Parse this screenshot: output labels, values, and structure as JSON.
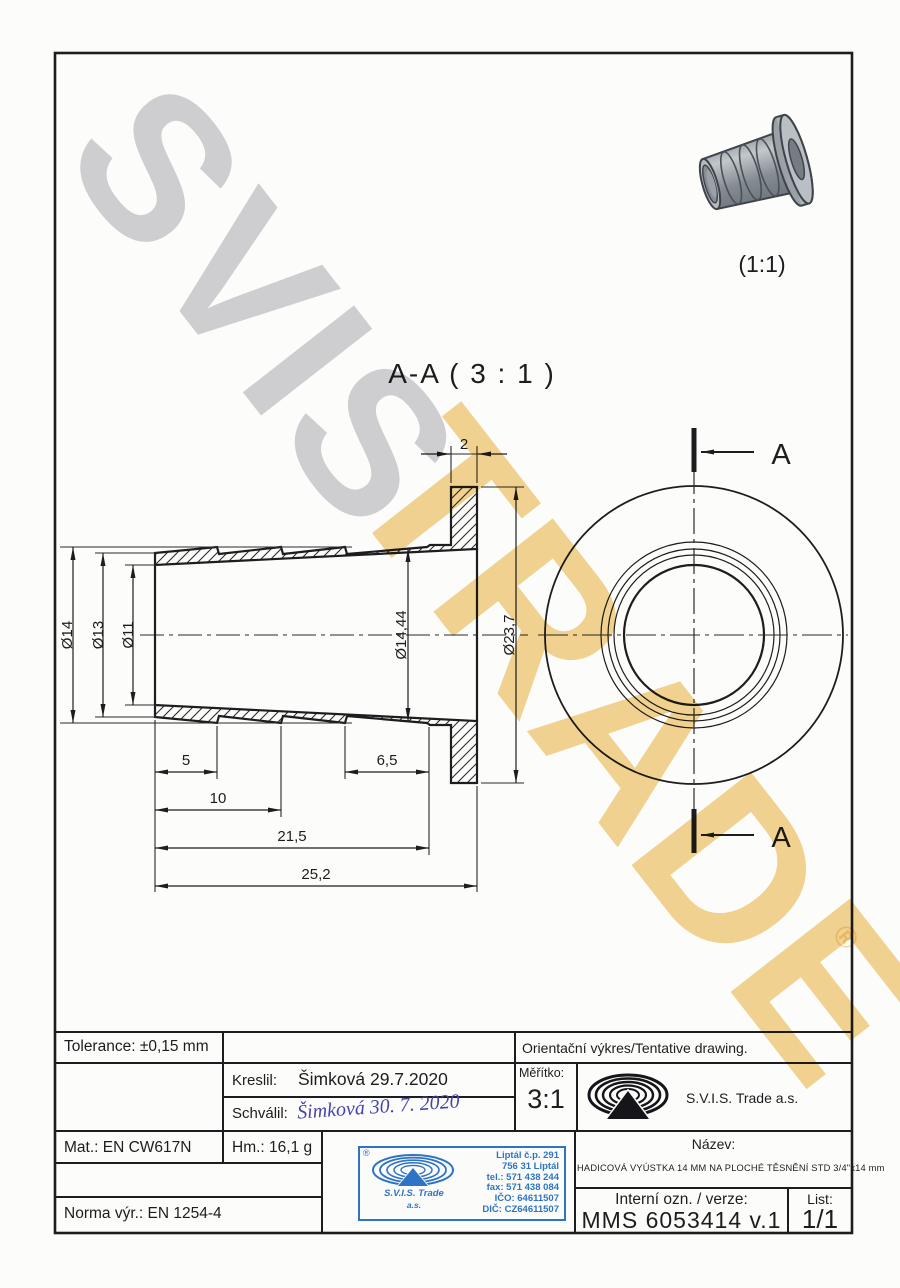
{
  "watermark": {
    "word1": "SVIS",
    "word2": "TRADE",
    "registered": "®"
  },
  "preview": {
    "scale": "(1:1)"
  },
  "drawing": {
    "section_title": "A-A ( 3 : 1 )",
    "cut_label_top": "A",
    "cut_label_bottom": "A",
    "dim_d14": "Ø14",
    "dim_d13": "Ø13",
    "dim_d11": "Ø11",
    "dim_d1444": "Ø14,44",
    "dim_d237": "Ø23,7",
    "dim_2": "2",
    "dim_5": "5",
    "dim_65": "6,5",
    "dim_10": "10",
    "dim_215": "21,5",
    "dim_252": "25,2"
  },
  "titleblock": {
    "tolerance": "Tolerance: ±0,15 mm",
    "orient": "Orientační výkres/Tentative drawing.",
    "kreslil_label": "Kreslil:",
    "kreslil_value": "Šimková 29.7.2020",
    "schvalil_label": "Schválil:",
    "schvalil_value": "Šimková 30. 7. 2020",
    "meritko_label": "Měřítko:",
    "meritko_value": "3:1",
    "company": "S.V.I.S. Trade a.s.",
    "mat": "Mat.: EN CW617N",
    "hm": "Hm.: 16,1 g",
    "norma": "Norma výr.: EN 1254-4",
    "nazev_label": "Název:",
    "nazev_value": "HADICOVÁ VYÚSTKA 14 MM NA PLOCHÉ TĚSNĚNÍ STD 3/4\"x14 mm",
    "interni_label": "Interní ozn. / verze:",
    "interni_value": "MMS 6053414 v.1",
    "list_label": "List:",
    "list_value": "1/1"
  },
  "stamp": {
    "registered": "®",
    "company_line1": "S.V.I.S. Trade",
    "company_line2": "a.s.",
    "lines": [
      "Liptál č.p. 291",
      "756 31 Liptál",
      "tel.: 571 438 244",
      "fax: 571 438 084",
      "IČO: 64611507",
      "DIČ: CZ64611507"
    ]
  },
  "colors": {
    "ink": "#1d1d1f",
    "stamp_blue": "#2f74c4",
    "watermark_gray": "#c6c6ca",
    "watermark_gold": "#f2d086"
  }
}
